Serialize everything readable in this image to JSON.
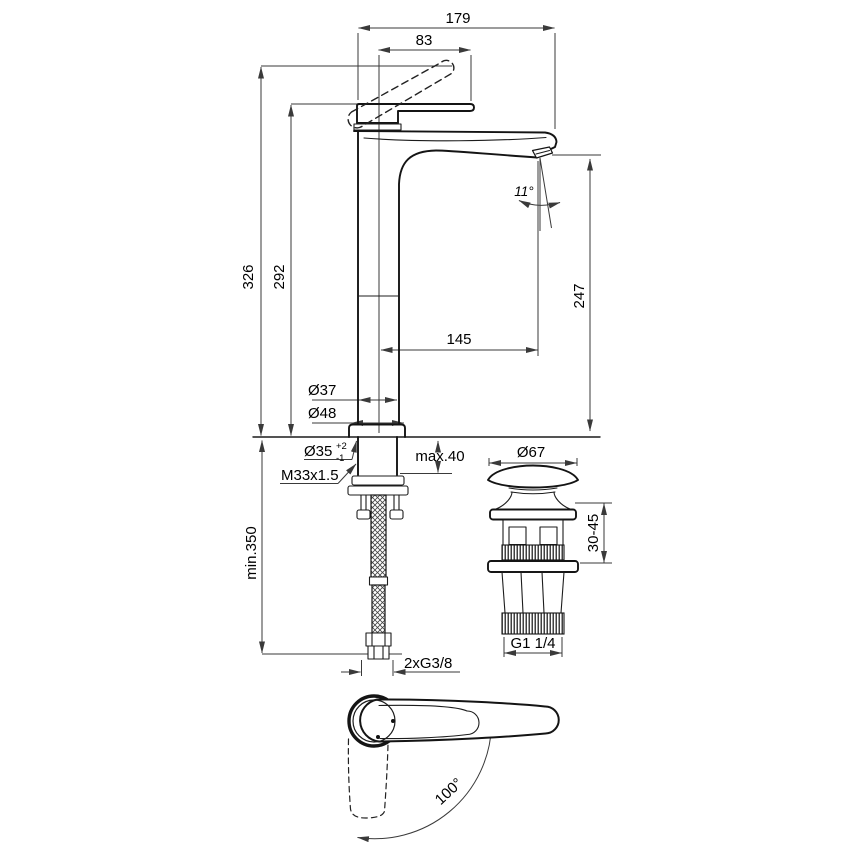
{
  "title": "basin-mixer-technical-drawing",
  "dims": {
    "width_total": "179",
    "lever_reach": "83",
    "height_open": "326",
    "height_closed": "292",
    "spout_height": "247",
    "spout_reach": "145",
    "spout_angle": "11°",
    "body_dia": "Ø37",
    "base_dia": "Ø48",
    "hole_dia": "Ø35",
    "hole_tol_plus": "+2",
    "hole_tol_minus": "-1",
    "shank_thread": "M33x1.5",
    "max_deck": "max.40",
    "drain_cap_dia": "Ø67",
    "drain_range": "30-45",
    "drain_thread": "G1 1/4",
    "hose_min_length": "min.350",
    "hose_thread": "2xG3/8",
    "handle_swing": "100°"
  }
}
